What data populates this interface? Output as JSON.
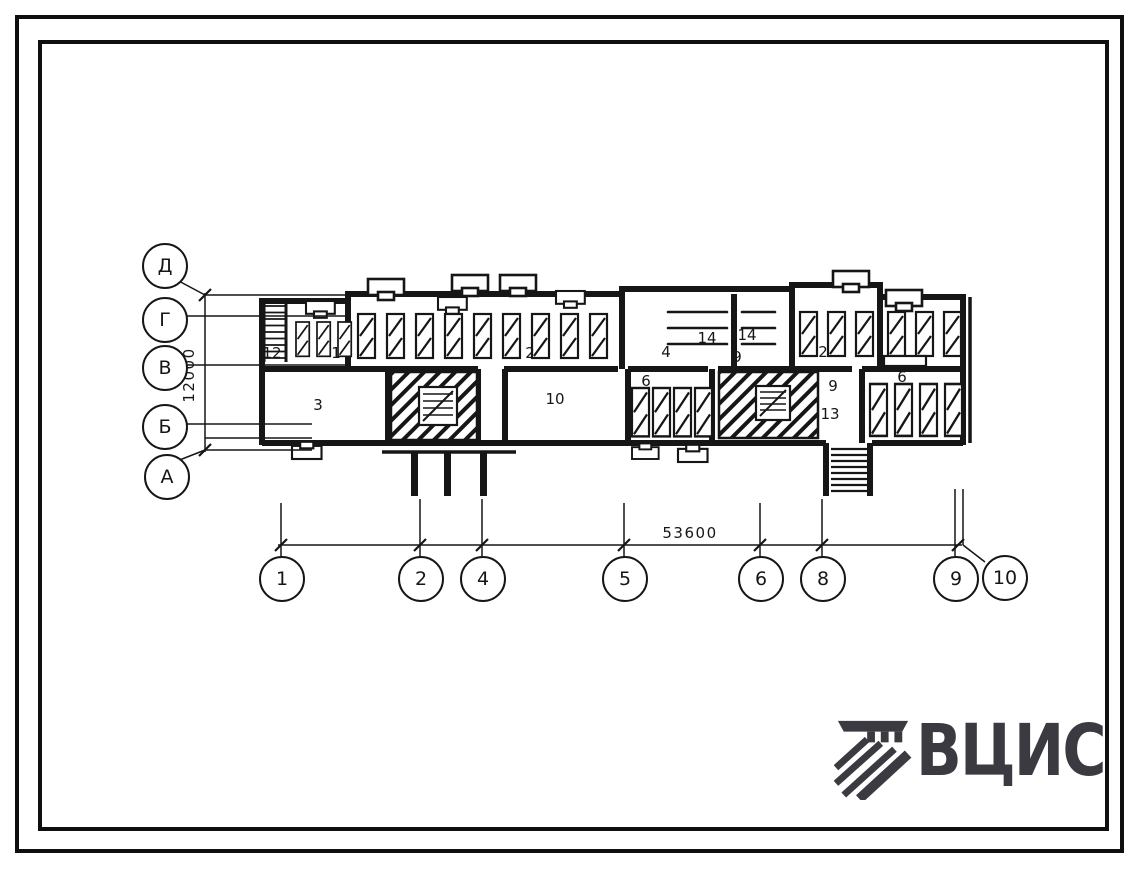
{
  "sheet": {
    "type_label": "floor-plan drawing"
  },
  "axes": {
    "rows": [
      "Д",
      "Г",
      "В",
      "Б",
      "А"
    ],
    "cols": [
      "1",
      "2",
      "4",
      "5",
      "6",
      "8",
      "9",
      "10"
    ]
  },
  "dims": {
    "vertical": "12000",
    "horizontal": "53600"
  },
  "rooms": [
    "12",
    "1",
    "3",
    "2",
    "4",
    "10",
    "6",
    "14",
    "14",
    "9",
    "2",
    "9",
    "13",
    "6"
  ],
  "logo": {
    "text": "ВЦИС"
  },
  "colors": {
    "ink": "#161616",
    "logo": "#3a3a40",
    "paper": "#ffffff"
  }
}
